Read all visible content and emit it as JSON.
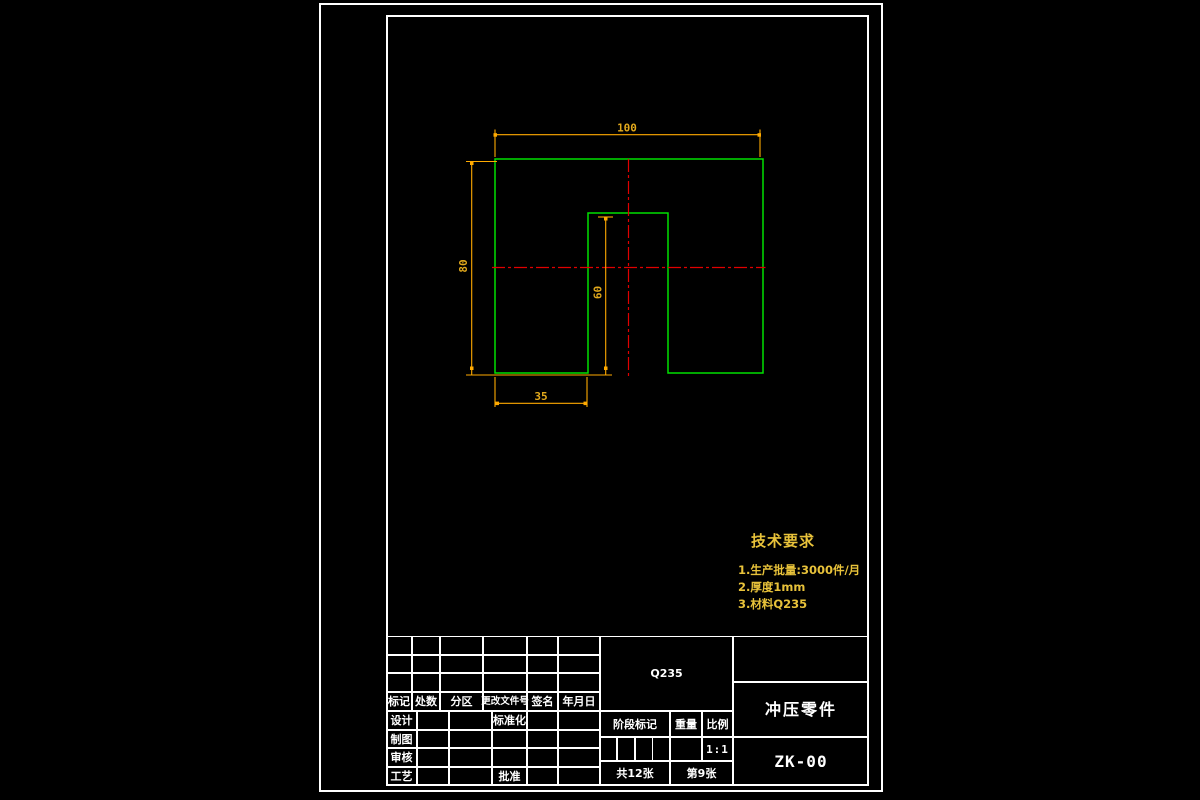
{
  "colors": {
    "background": "#000000",
    "frame": "#ffffff",
    "part_outline": "#00e000",
    "centerline": "#e00000",
    "dimension": "#ffaa00",
    "annotation_text": "#e8c23a"
  },
  "drawing": {
    "dims": {
      "overall_width": "100",
      "overall_height": "80",
      "notch_height": "60",
      "notch_offset": "35"
    }
  },
  "tech_requirements": {
    "title": "技术要求",
    "items": [
      "1.生产批量:3000件/月",
      "2.厚度1mm",
      "3.材料Q235"
    ]
  },
  "title_block": {
    "header_row": [
      "标记",
      "处数",
      "分区",
      "更改文件号",
      "签名",
      "年月日"
    ],
    "left_rows": [
      "设计",
      "制图",
      "审核",
      "工艺"
    ],
    "standardization": "标准化",
    "approval": "批准",
    "material": "Q235",
    "stage_mark": "阶段标记",
    "weight_label": "重量",
    "scale_label": "比例",
    "scale_value": "1:1",
    "sheets_total": "共12张",
    "sheet_number": "第9张",
    "part_name": "冲压零件",
    "drawing_number": "ZK-00"
  }
}
